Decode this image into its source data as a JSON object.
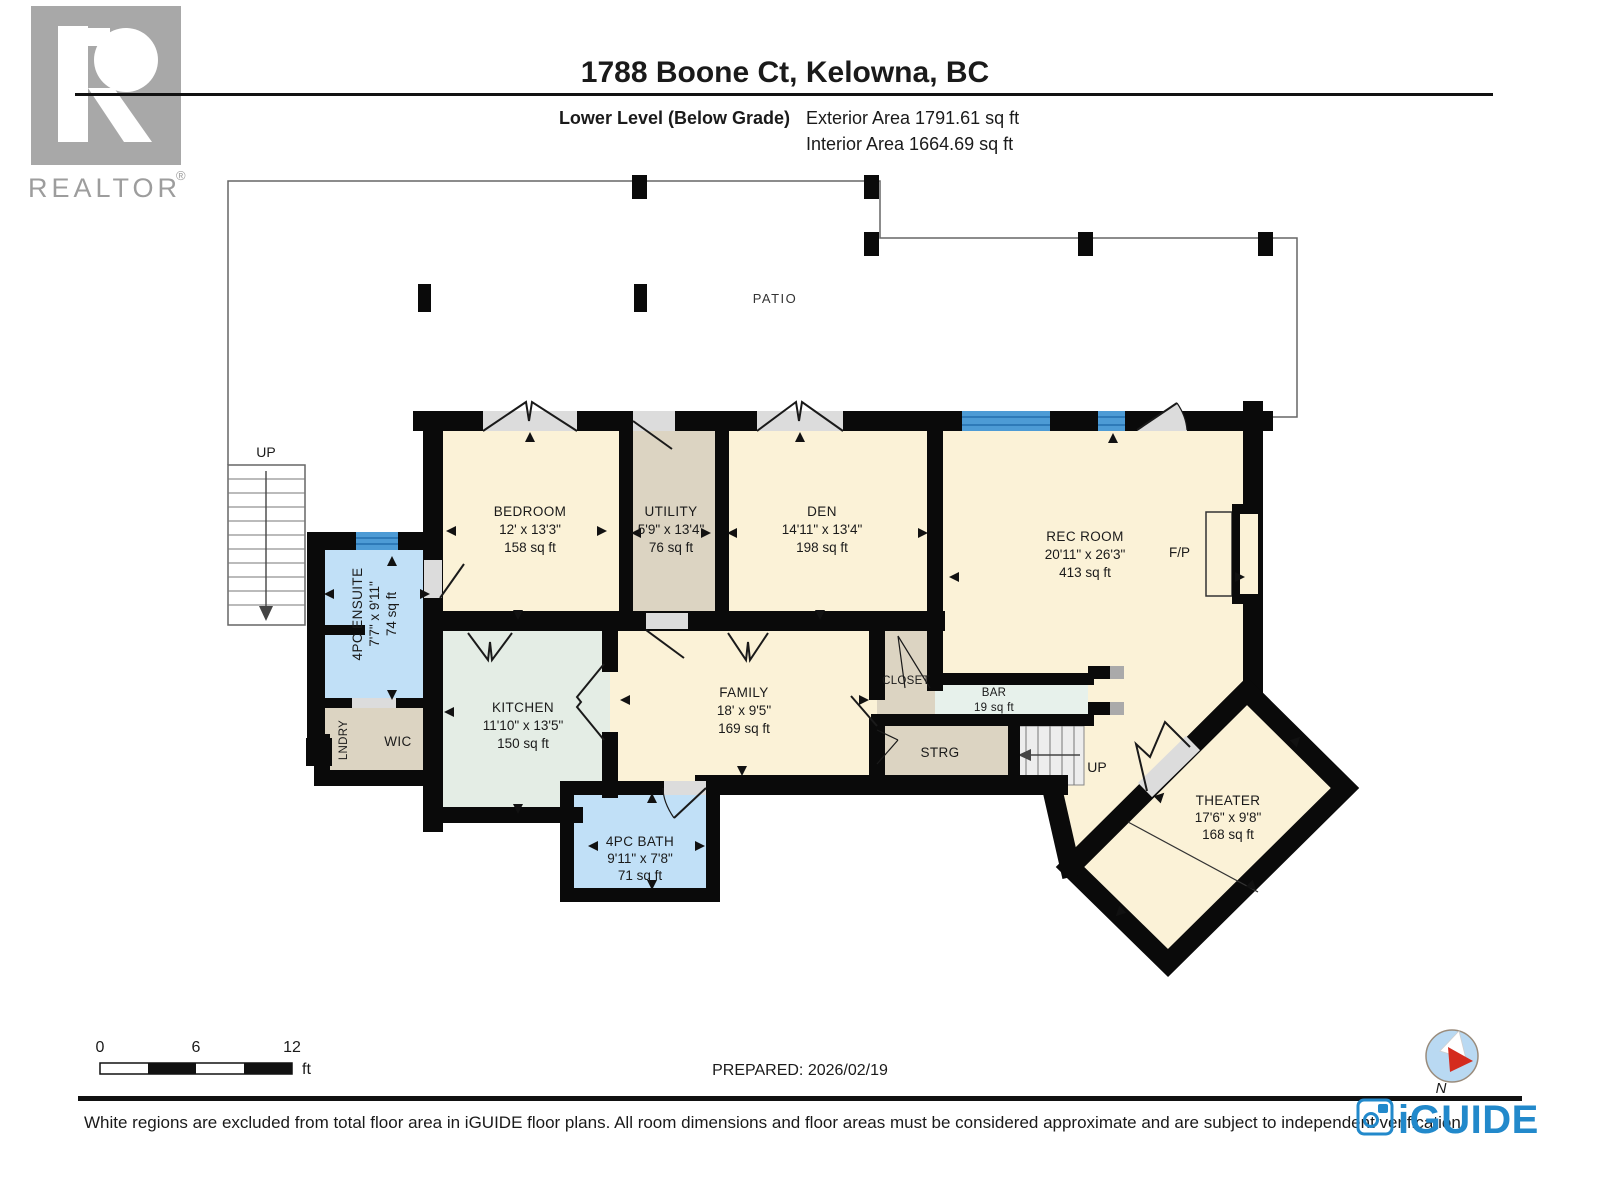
{
  "header": {
    "realtor_text": "REALTOR",
    "registered_mark": "®",
    "title": "1788 Boone Ct, Kelowna, BC",
    "level_label": "Lower Level (Below Grade)",
    "exterior_area": "Exterior Area 1791.61 sq ft",
    "interior_area": "Interior Area 1664.69 sq ft"
  },
  "plan": {
    "patio_label": "PATIO",
    "exterior_stairs_label": "UP",
    "interior_stairs_label": "UP",
    "fireplace_label": "F/P",
    "rooms": {
      "bedroom": {
        "name": "BEDROOM",
        "dims": "12' x 13'3\"",
        "area": "158 sq ft"
      },
      "utility": {
        "name": "UTILITY",
        "dims": "5'9\" x 13'4\"",
        "area": "76 sq ft"
      },
      "den": {
        "name": "DEN",
        "dims": "14'11\" x 13'4\"",
        "area": "198 sq ft"
      },
      "rec_room": {
        "name": "REC ROOM",
        "dims": "20'11\" x 26'3\"",
        "area": "413 sq ft"
      },
      "ensuite": {
        "name": "4PC ENSUITE",
        "dims": "7'7\" x 9'11\"",
        "area": "74 sq ft"
      },
      "kitchen": {
        "name": "KITCHEN",
        "dims": "11'10\" x 13'5\"",
        "area": "150 sq ft"
      },
      "family": {
        "name": "FAMILY",
        "dims": "18' x 9'5\"",
        "area": "169 sq ft"
      },
      "bath": {
        "name": "4PC BATH",
        "dims": "9'11\" x 7'8\"",
        "area": "71 sq ft"
      },
      "theater": {
        "name": "THEATER",
        "dims": "17'6\" x 9'8\"",
        "area": "168 sq ft"
      },
      "bar": {
        "name": "BAR",
        "area": "19 sq ft"
      },
      "closet": {
        "name": "CLOSET"
      },
      "strg": {
        "name": "STRG"
      },
      "wic": {
        "name": "WIC"
      },
      "lndry": {
        "name": "LNDRY"
      }
    }
  },
  "footer": {
    "scale": {
      "tick0": "0",
      "tick6": "6",
      "tick12": "12",
      "unit": "ft"
    },
    "prepared": "PREPARED: 2026/02/19",
    "compass_label": "N",
    "brand": "iGUIDE",
    "disclaimer": "White regions are excluded from total floor area in iGUIDE floor plans. All room dimensions and floor areas must be considered approximate and are subject to independent verification."
  },
  "colors": {
    "wall": "#0a0a0a",
    "cream": "#FBF2D7",
    "tan": "#DCD4C2",
    "blue": "#C1E0F7",
    "kitchen": "#E4EDE5",
    "bar": "#E7F1EB",
    "door": "#DCDCDC",
    "window": "#4D9BD5",
    "brand": "#2289CB",
    "compass_fill": "#B9D9F2",
    "compass_red": "#D42B1E"
  }
}
